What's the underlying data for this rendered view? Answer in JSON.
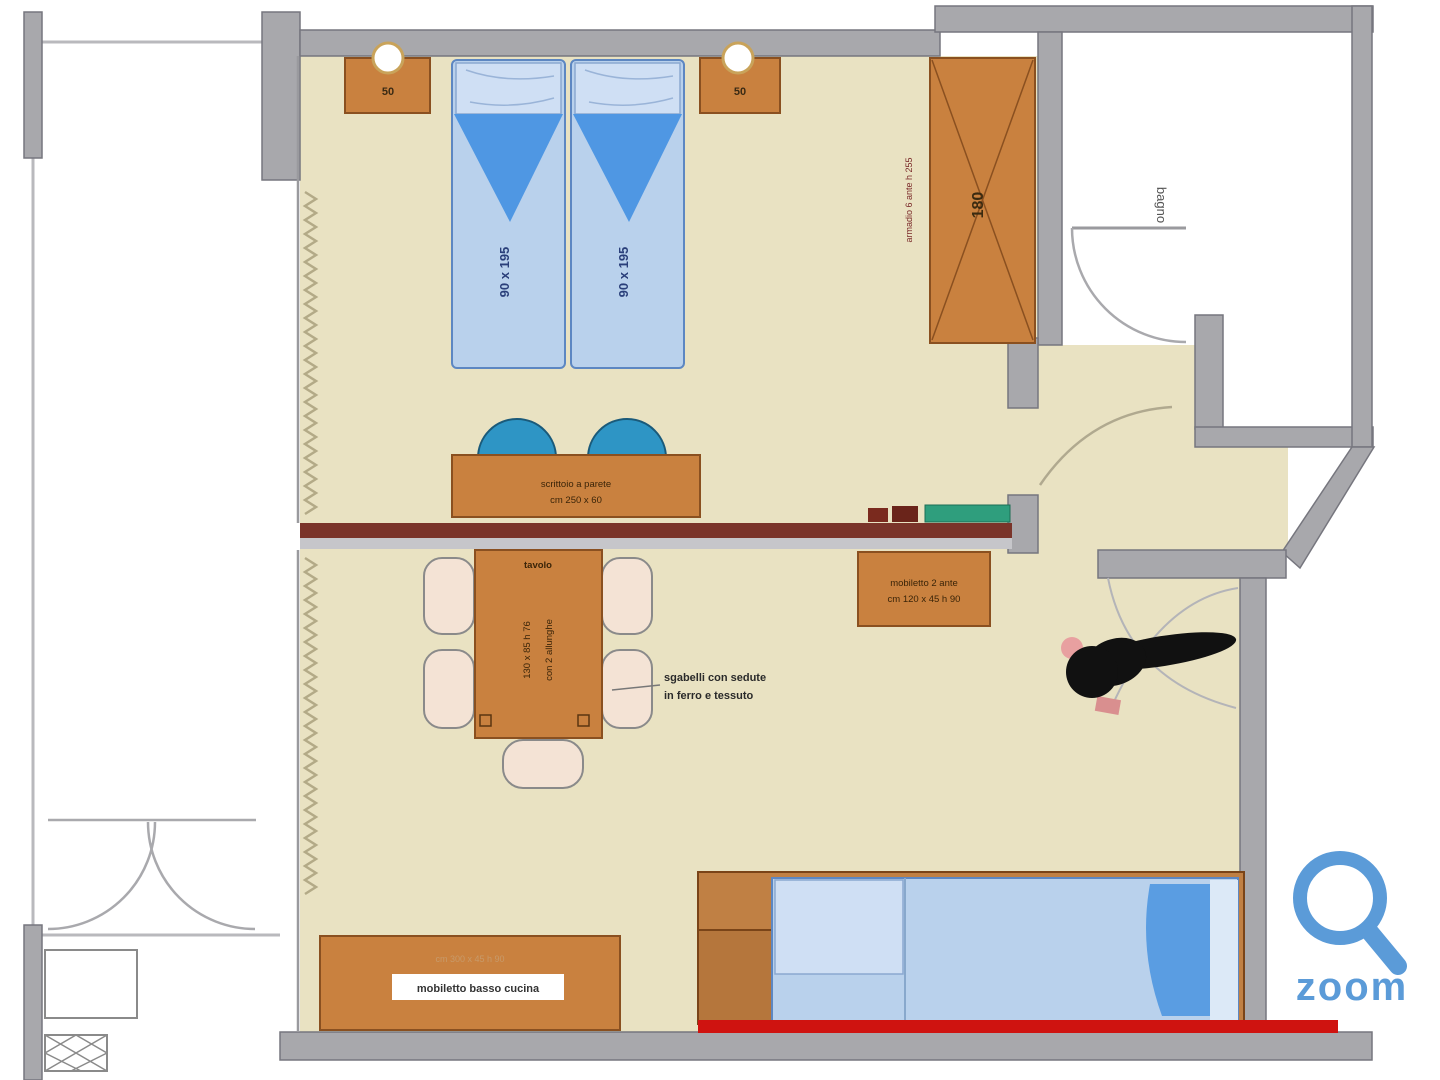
{
  "plan": {
    "bedroom": {
      "nightstand_left": "50",
      "nightstand_right": "50",
      "bed_size_left": "90 x 195",
      "bed_size_right": "90 x 195",
      "wardrobe_size": "180",
      "wardrobe_note": "armadio 6 ante h 255",
      "desk_line1": "scrittoio a parete",
      "desk_line2": "cm 250 x 60"
    },
    "bathroom": {
      "label": "bagno"
    },
    "living": {
      "table_label": "tavolo",
      "table_dim": "130 x 85 h 76",
      "table_dim2": "con 2 allunghe",
      "note_line1": "sgabelli con sedute",
      "note_line2": "in ferro e tessuto",
      "kitchen_cab_line1": "mobiletto 2 ante",
      "kitchen_cab_line2": "cm 120 x 45 h 90",
      "low_cab_top": "cm 300 x 45 h 90",
      "low_cab_label": "mobiletto basso cucina"
    }
  },
  "watermark": {
    "label": "zoom"
  },
  "colors": {
    "floor": "#e9e2c2",
    "wall_gray": "#a8a8ac",
    "wood": "#c9813f",
    "mattress_blue": "#b9d1ec",
    "pillow_blue": "#cfdff4",
    "blanket_blue": "#4f97e3",
    "chair_teal": "#2e95c5",
    "chair_pale": "#f4e3d5",
    "partition_red": "#7a342a",
    "highlight_red": "#cf1310",
    "counter_green": "#2f9e7d",
    "logo_blue": "#5b9bd8",
    "bed_text_navy": "#2a3f7a"
  }
}
